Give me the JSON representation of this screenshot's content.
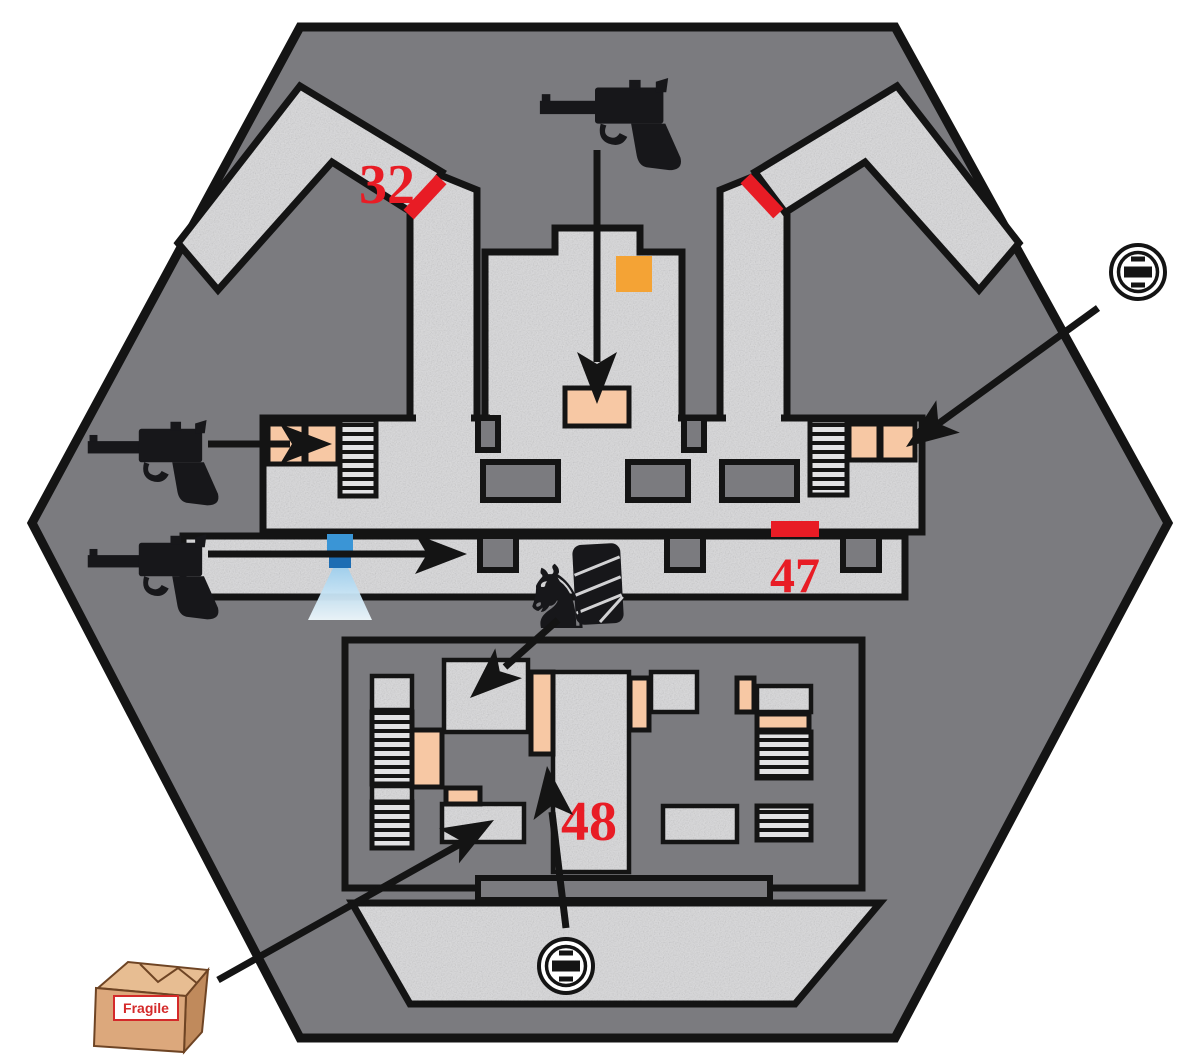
{
  "map": {
    "kind": "hexagonal-level-floorplan",
    "area_labels": {
      "l32": "32",
      "l47": "47",
      "l48": "48"
    },
    "crate": {
      "label": "Fragile"
    },
    "icons": {
      "pistol": "black-pistol-silhouette",
      "power_socket": "double-circle-with-center-bar",
      "security_camera": "blue-square-with-light-cone",
      "knight_statue": "♞",
      "wrapped_bundle": "black-cylinder-with-white-straps",
      "fragile_crate": "cardboard-box",
      "item_marker": "orange-square"
    },
    "colors": {
      "background": "#ffffff",
      "wall_fill": "#7b7b7f",
      "wall_line": "#141414",
      "floor": "#d6d6d8",
      "door_room": "#f7c8a4",
      "marker_red": "#e81c25",
      "item_orange": "#f4a335",
      "camera_blue": "#2f8fd0",
      "camera_cone": "#bfe2f6",
      "crate_tan": "#dca87c"
    }
  }
}
